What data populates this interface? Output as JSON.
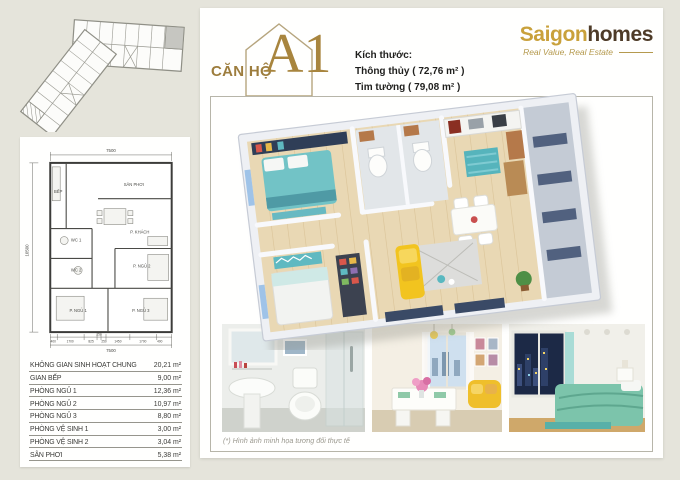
{
  "logo": {
    "part1": "Saigon",
    "part2": "homes",
    "tagline": "Real Value, Real Estate"
  },
  "header": {
    "unit_prefix": "CĂN HỘ",
    "unit_code": "A1",
    "size_label": "Kích thước:",
    "size_net": "Thông thủy ( 72,76 m² )",
    "size_gross": "Tim tường ( 79,08 m² )"
  },
  "floorplan2d": {
    "dim_top": "7500",
    "dim_bottom_total": "7500",
    "dim_left": "10500",
    "dim_bottom_segments": [
      "400",
      "1700",
      "825",
      "250",
      "250",
      "1450",
      "1700",
      "400"
    ],
    "rooms": {
      "san_phoi": "SÂN PHƠI",
      "khach": "P. KHÁCH",
      "bep": "BẾP",
      "wc1": "WC 1",
      "wc2": "WC 2",
      "ngu1": "P. NGỦ 1",
      "ngu2": "P. NGỦ 2",
      "ngu3": "P. NGỦ 3"
    }
  },
  "area_table": {
    "unit": "m²",
    "rows": [
      {
        "label": "KHÔNG GIAN SINH HOẠT CHUNG",
        "value": "20,21"
      },
      {
        "label": "GIAN BẾP",
        "value": "9,00"
      },
      {
        "label": "PHÒNG NGỦ 1",
        "value": "12,36"
      },
      {
        "label": "PHÒNG NGỦ 2",
        "value": "10,97"
      },
      {
        "label": "PHÒNG NGỦ 3",
        "value": "8,80"
      },
      {
        "label": "PHÒNG VỆ SINH 1",
        "value": "3,00"
      },
      {
        "label": "PHÒNG VỆ SINH 2",
        "value": "3,04"
      },
      {
        "label": "SÂN PHƠI",
        "value": "5,38"
      }
    ]
  },
  "gallery": {
    "caption": "(*) Hình ảnh minh họa tương đối thực tế"
  },
  "colors": {
    "gold": "#a8853e",
    "logo_gold": "#c9a13b",
    "logo_brown": "#4e3b28",
    "teal": "#62bec4",
    "sofa_yellow": "#f2c41f"
  }
}
